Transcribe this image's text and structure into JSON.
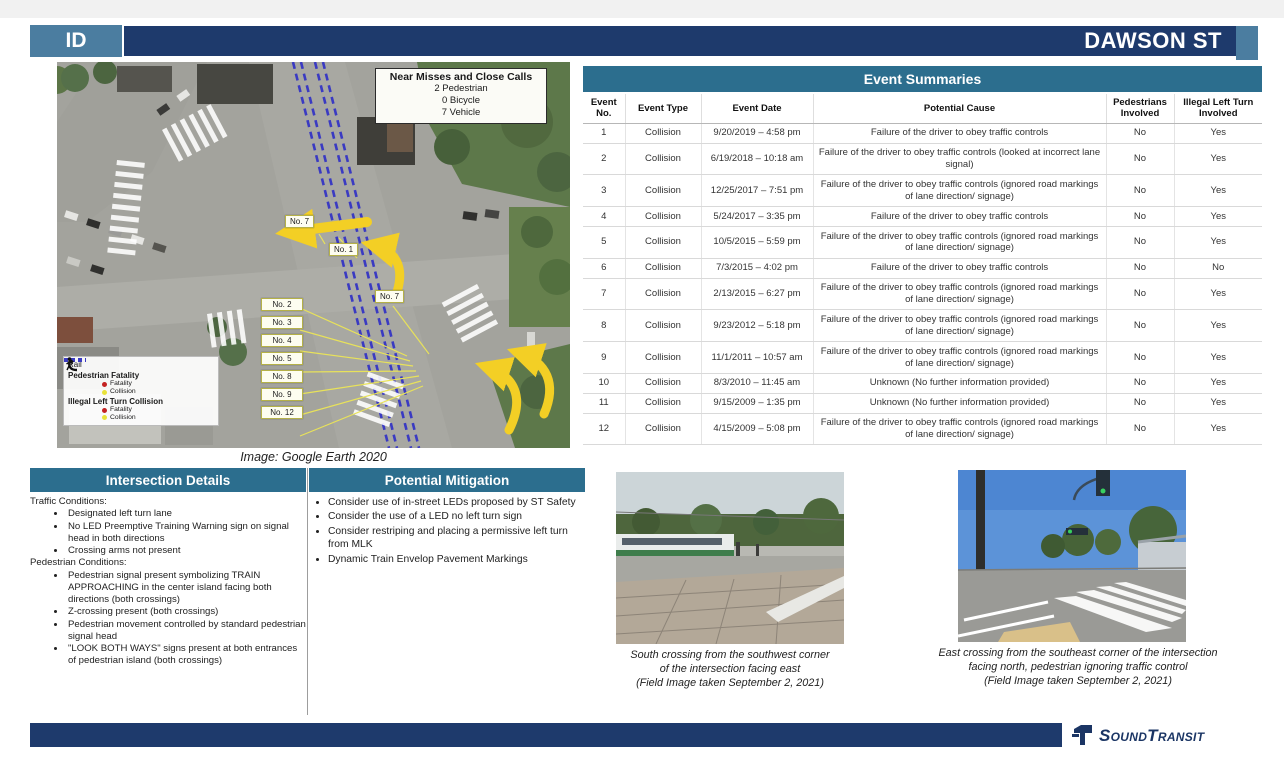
{
  "header": {
    "id_label": "ID",
    "title": "DAWSON ST"
  },
  "colors": {
    "banner_teal": "#2c6e8e",
    "navy_bar": "#1e3a6c",
    "steel_blue": "#4b7da0",
    "arrow_yellow": "#f3cf25",
    "rail_blue": "#3a3ac2",
    "fatality_red": "#c42222",
    "collision_yellow": "#e8e23a"
  },
  "map": {
    "caption": "Image: Google Earth 2020",
    "near_miss": {
      "title": "Near Misses and Close Calls",
      "stats": [
        "2 Pedestrian",
        "0 Bicycle",
        "7 Vehicle"
      ]
    },
    "legend": {
      "rail": "Rail",
      "pedestrian": "Pedestrian Fatality",
      "pedestrian_fatality": "Fatality",
      "pedestrian_collision": "Collision",
      "left_turn": "Illegal Left Turn Collision",
      "left_turn_fatality": "Fatality",
      "left_turn_collision": "Collision"
    },
    "labels": {
      "top": "No. 7",
      "second": "No. 1",
      "right": "No. 7",
      "column": [
        "No. 2",
        "No. 3",
        "No. 4",
        "No. 5",
        "No. 8",
        "No. 9",
        "No. 12"
      ]
    }
  },
  "event_table": {
    "title": "Event Summaries",
    "columns": [
      "Event No.",
      "Event Type",
      "Event Date",
      "Potential Cause",
      "Pedestrians Involved",
      "Illegal Left Turn Involved"
    ],
    "rows": [
      {
        "no": "1",
        "type": "Collision",
        "date": "9/20/2019 – 4:58 pm",
        "cause": "Failure of the driver to obey traffic controls",
        "ped": "No",
        "turn": "Yes"
      },
      {
        "no": "2",
        "type": "Collision",
        "date": "6/19/2018 – 10:18 am",
        "cause": "Failure of the driver to obey traffic controls (looked at incorrect lane signal)",
        "ped": "No",
        "turn": "Yes"
      },
      {
        "no": "3",
        "type": "Collision",
        "date": "12/25/2017 – 7:51 pm",
        "cause": "Failure of the driver to obey traffic controls (ignored road markings of lane direction/ signage)",
        "ped": "No",
        "turn": "Yes"
      },
      {
        "no": "4",
        "type": "Collision",
        "date": "5/24/2017 – 3:35 pm",
        "cause": "Failure of the driver to obey traffic controls",
        "ped": "No",
        "turn": "Yes"
      },
      {
        "no": "5",
        "type": "Collision",
        "date": "10/5/2015 – 5:59 pm",
        "cause": "Failure of the driver to obey traffic controls (ignored road markings of lane direction/ signage)",
        "ped": "No",
        "turn": "Yes"
      },
      {
        "no": "6",
        "type": "Collision",
        "date": "7/3/2015 – 4:02 pm",
        "cause": "Failure of the driver to obey traffic controls",
        "ped": "No",
        "turn": "No"
      },
      {
        "no": "7",
        "type": "Collision",
        "date": "2/13/2015 – 6:27 pm",
        "cause": "Failure of the driver to obey traffic controls (ignored road markings of lane direction/ signage)",
        "ped": "No",
        "turn": "Yes"
      },
      {
        "no": "8",
        "type": "Collision",
        "date": "9/23/2012 – 5:18 pm",
        "cause": "Failure of the driver to obey traffic controls (ignored road markings of lane direction/ signage)",
        "ped": "No",
        "turn": "Yes"
      },
      {
        "no": "9",
        "type": "Collision",
        "date": "11/1/2011 – 10:57 am",
        "cause": "Failure of the driver to obey traffic controls (ignored road markings of lane direction/ signage)",
        "ped": "No",
        "turn": "Yes"
      },
      {
        "no": "10",
        "type": "Collision",
        "date": "8/3/2010 – 11:45 am",
        "cause": "Unknown (No further information provided)",
        "ped": "No",
        "turn": "Yes"
      },
      {
        "no": "11",
        "type": "Collision",
        "date": "9/15/2009 – 1:35 pm",
        "cause": "Unknown (No further information provided)",
        "ped": "No",
        "turn": "Yes"
      },
      {
        "no": "12",
        "type": "Collision",
        "date": "4/15/2009 – 5:08 pm",
        "cause": "Failure of the driver to obey traffic controls (ignored road markings of lane direction/ signage)",
        "ped": "No",
        "turn": "Yes"
      }
    ]
  },
  "intersection_details": {
    "title": "Intersection Details",
    "groups": [
      {
        "heading": "Traffic Conditions:",
        "items": [
          "Designated left turn lane",
          "No LED Preemptive Training Warning sign on signal head in both directions",
          "Crossing arms not present"
        ]
      },
      {
        "heading": "Pedestrian Conditions:",
        "items": [
          "Pedestrian signal present symbolizing TRAIN APPROACHING in the center island facing both directions (both crossings)",
          "Z-crossing present (both crossings)",
          "Pedestrian movement controlled by standard pedestrian signal head",
          "\"LOOK BOTH WAYS\" signs present at both entrances of pedestrian island (both crossings)"
        ]
      }
    ]
  },
  "potential_mitigation": {
    "title": "Potential Mitigation",
    "items": [
      "Consider use of in-street LEDs proposed by ST Safety",
      "Consider the use of a LED no left turn sign",
      "Consider restriping and placing a permissive left turn from MLK",
      "Dynamic Train Envelop Pavement Markings"
    ]
  },
  "photos": [
    {
      "caption": "South crossing from the southwest corner\nof the intersection facing east\n(Field Image taken September 2, 2021)"
    },
    {
      "caption": "East crossing from the southeast corner of the intersection facing north, pedestrian ignoring traffic control\n(Field Image taken September 2, 2021)"
    }
  ],
  "footer": {
    "brand": "SoundTransit"
  }
}
